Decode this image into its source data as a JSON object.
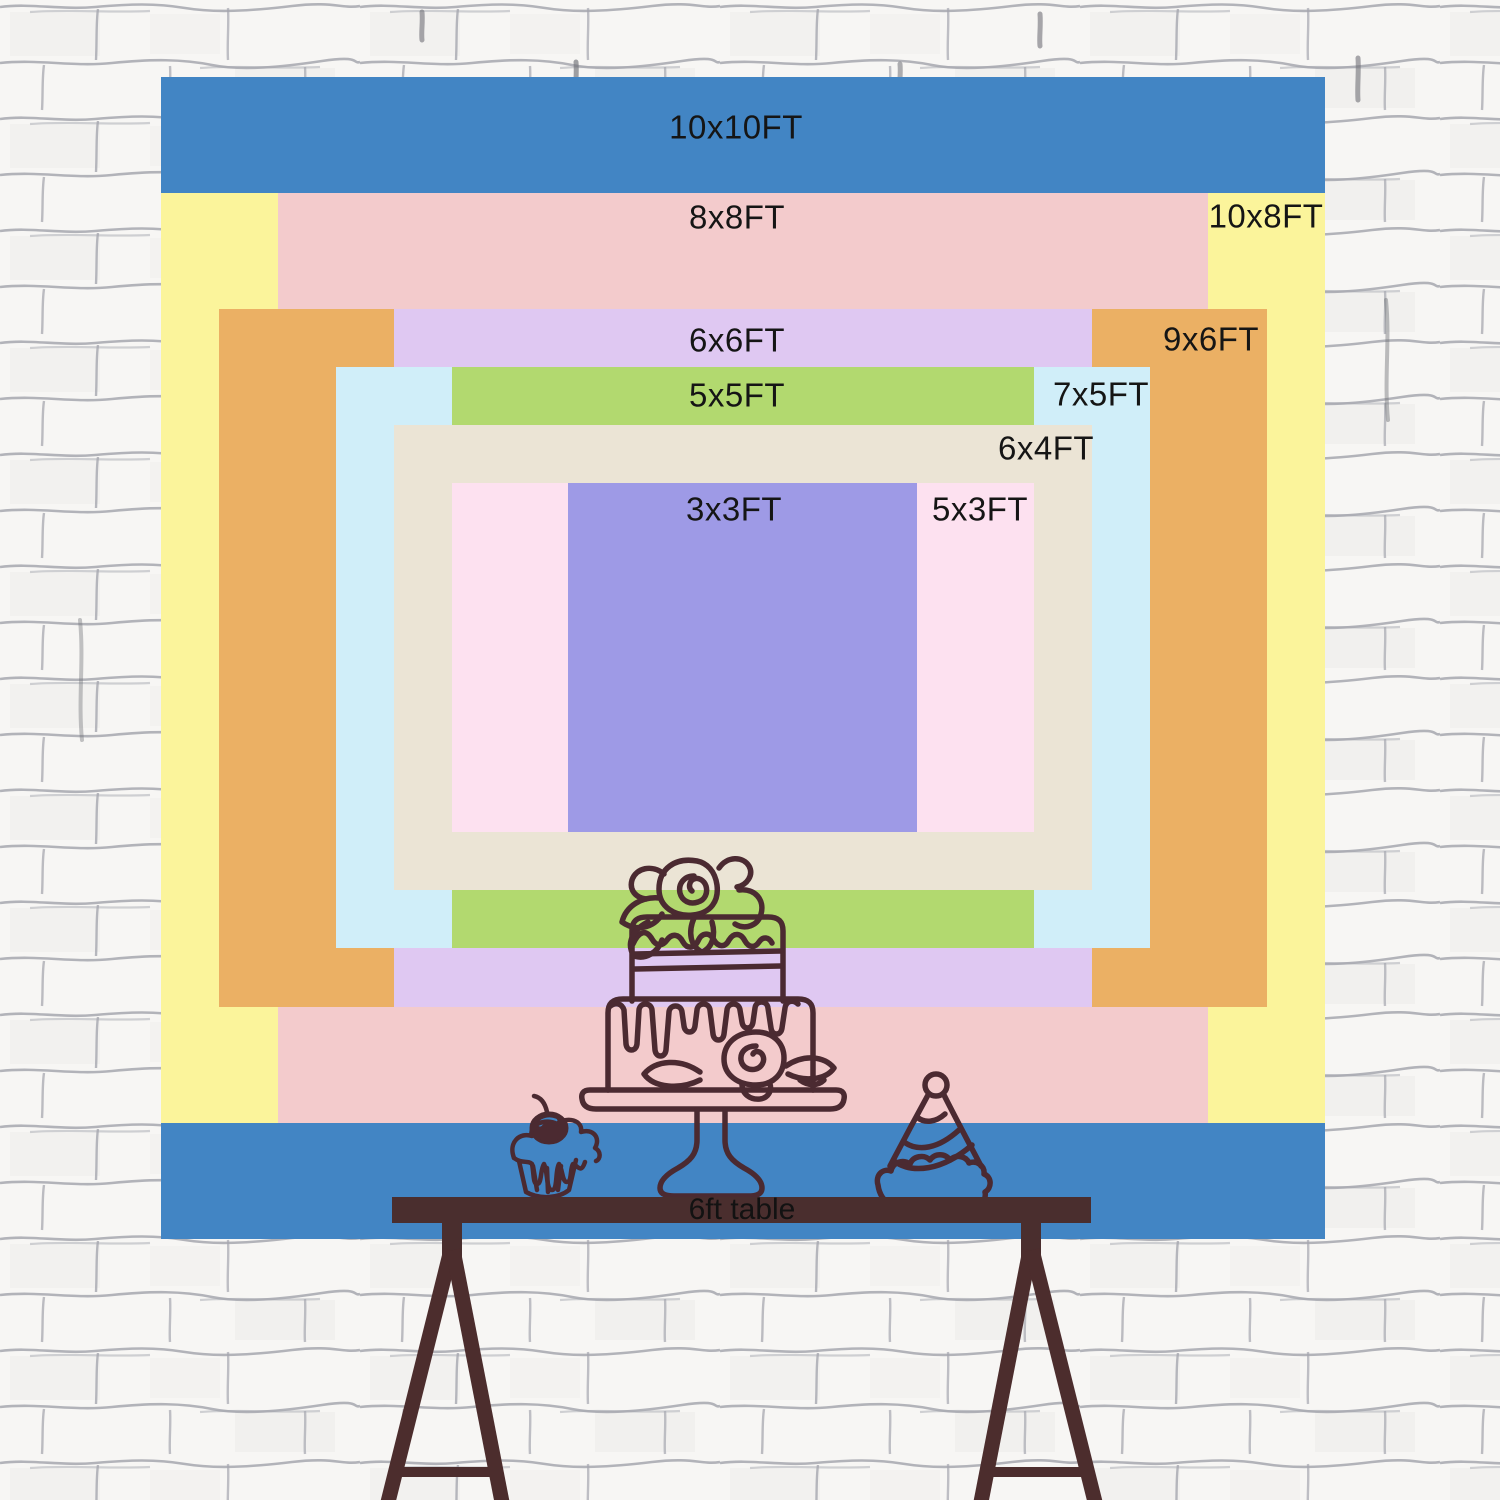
{
  "backdrop": {
    "sizes": [
      {
        "id": "10x10ft",
        "label": "10x10FT",
        "color": "#4285c4"
      },
      {
        "id": "10x8ft",
        "label": "10x8FT",
        "color": "#fbf49b"
      },
      {
        "id": "8x8ft",
        "label": "8x8FT",
        "color": "#f3cbcc"
      },
      {
        "id": "9x6ft",
        "label": "9x6FT",
        "color": "#ebb064"
      },
      {
        "id": "6x6ft",
        "label": "6x6FT",
        "color": "#dfc8f2"
      },
      {
        "id": "7x5ft",
        "label": "7x5FT",
        "color": "#d0eef9"
      },
      {
        "id": "5x5ft",
        "label": "5x5FT",
        "color": "#b2d96f"
      },
      {
        "id": "6x4ft",
        "label": "6x4FT",
        "color": "#ebe4d5"
      },
      {
        "id": "5x3ft",
        "label": "5x3FT",
        "color": "#fde1f0"
      },
      {
        "id": "3x3ft",
        "label": "3x3FT",
        "color": "#9e9ae6"
      }
    ],
    "label_color": "#151515"
  },
  "table": {
    "label": "6ft table",
    "color": "#4a2e2e",
    "legs_color": "#4c2d2d"
  },
  "illustrations": {
    "line_color": "#4b2a31",
    "items": [
      {
        "name": "cake-icon"
      },
      {
        "name": "cupcake-icon"
      },
      {
        "name": "party-hat-icon"
      }
    ]
  },
  "wall": {
    "base_color": "#f7f6f4",
    "mortar_color": "#a6a7af"
  }
}
